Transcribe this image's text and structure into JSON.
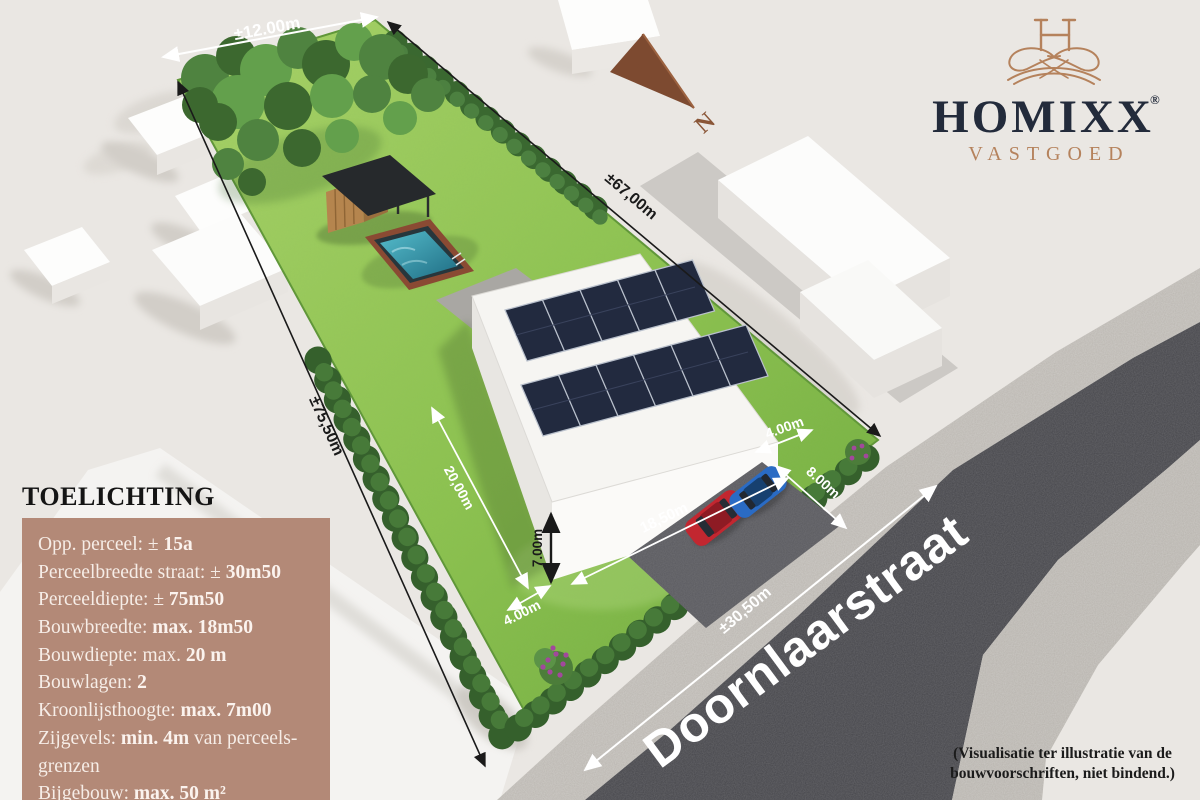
{
  "logo": {
    "brand": "HOMIXX",
    "registered": "®",
    "tagline": "VASTGOED"
  },
  "compass": {
    "label": "N"
  },
  "street": {
    "name": "Doornlaarstraat"
  },
  "dimensions": {
    "plot_back_width": "±12.00m",
    "plot_depth_left": "±75,50m",
    "plot_depth_right": "±67,00m",
    "street_frontage": "±30,50m",
    "build_depth": "20,00m",
    "clearance_left": "4.00m",
    "house_height": "7.00m",
    "build_width": "18,50m",
    "garden_front_depth": "8.00m",
    "clearance_right": "4.00m"
  },
  "legend": {
    "title": "TOELICHTING",
    "items": [
      {
        "pre": "Opp. perceel: ± ",
        "bold": "15a",
        "post": ""
      },
      {
        "pre": "Perceelbreedte straat: ± ",
        "bold": "30m50",
        "post": ""
      },
      {
        "pre": "Perceeldiepte: ± ",
        "bold": "75m50",
        "post": ""
      },
      {
        "pre": "Bouwbreedte: ",
        "bold": "max. 18m50",
        "post": ""
      },
      {
        "pre": "Bouwdiepte: max. ",
        "bold": "20 m",
        "post": ""
      },
      {
        "pre": "Bouwlagen: ",
        "bold": "2",
        "post": ""
      },
      {
        "pre": "Kroonlijsthoogte: ",
        "bold": "max. 7m00",
        "post": ""
      },
      {
        "pre": "Zijgevels: ",
        "bold": "min. 4m",
        "post": " van perceels-grenzen"
      },
      {
        "pre": "Bijgebouw: ",
        "bold": "max. 50 m²",
        "post": ""
      }
    ]
  },
  "disclaimer": "(Visualisatie ter illustratie van de bouwvoorschriften, niet bindend.)",
  "colors": {
    "copper": "#b5825c",
    "navy": "#232b3b",
    "panel_bg": "#b38977",
    "panel_text": "#f6ede7",
    "grass": "#8fc452",
    "asphalt": "#47474b",
    "water": "#2f8ba0"
  }
}
